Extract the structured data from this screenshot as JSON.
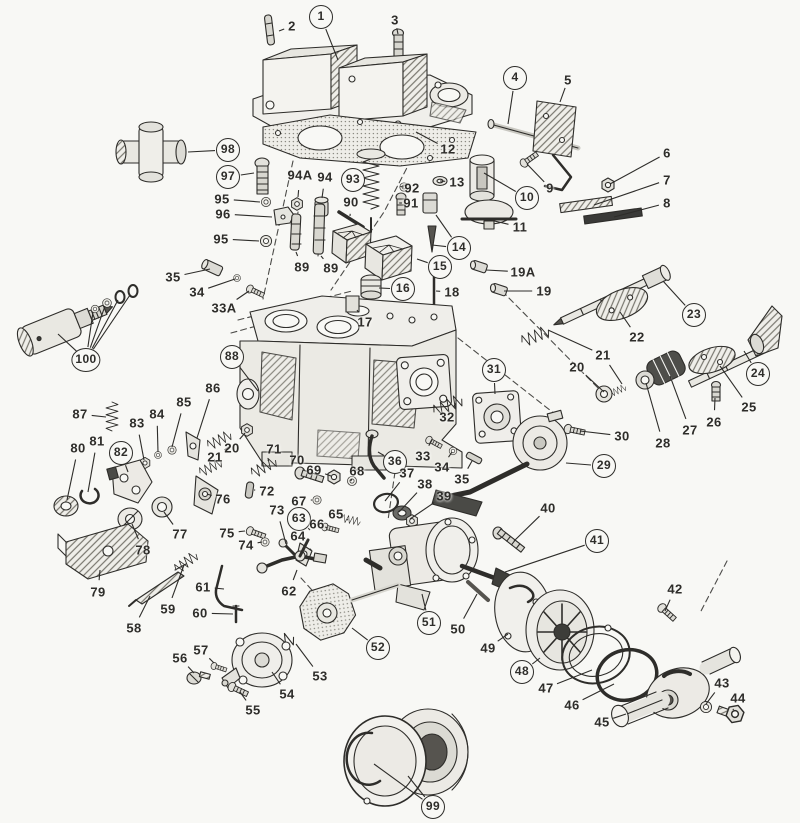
{
  "figure": {
    "kind": "exploded-parts-diagram",
    "canvas": {
      "w": 800,
      "h": 823
    }
  },
  "colors": {
    "paper": "#f8f8f5",
    "ink": "#2e2d2a"
  },
  "labels": [
    {
      "t": "1",
      "x": 321,
      "y": 17,
      "c": 1,
      "l": [
        [
          338,
          60
        ]
      ]
    },
    {
      "t": "2",
      "x": 292,
      "y": 26,
      "c": 0,
      "l": [
        [
          279,
          31
        ]
      ]
    },
    {
      "t": "3",
      "x": 395,
      "y": 20,
      "c": 0,
      "l": [
        [
          398,
          34
        ]
      ]
    },
    {
      "t": "4",
      "x": 515,
      "y": 78,
      "c": 1,
      "l": [
        [
          508,
          124
        ]
      ]
    },
    {
      "t": "5",
      "x": 568,
      "y": 80,
      "c": 0,
      "l": [
        [
          560,
          102
        ]
      ]
    },
    {
      "t": "6",
      "x": 667,
      "y": 153,
      "c": 0,
      "l": [
        [
          610,
          184
        ]
      ]
    },
    {
      "t": "7",
      "x": 667,
      "y": 180,
      "c": 0,
      "l": [
        [
          594,
          205
        ]
      ]
    },
    {
      "t": "8",
      "x": 667,
      "y": 203,
      "c": 0,
      "l": [
        [
          614,
          217
        ]
      ]
    },
    {
      "t": "9",
      "x": 550,
      "y": 188,
      "c": 0,
      "l": [
        [
          527,
          164
        ]
      ]
    },
    {
      "t": "10",
      "x": 527,
      "y": 198,
      "c": 1,
      "l": [
        [
          484,
          173
        ]
      ]
    },
    {
      "t": "11",
      "x": 520,
      "y": 227,
      "c": 0,
      "l": [
        [
          486,
          219
        ]
      ]
    },
    {
      "t": "12",
      "x": 448,
      "y": 149,
      "c": 0,
      "l": [
        [
          416,
          132
        ]
      ]
    },
    {
      "t": "13",
      "x": 457,
      "y": 182,
      "c": 0,
      "l": [
        [
          440,
          181
        ]
      ]
    },
    {
      "t": "14",
      "x": 459,
      "y": 248,
      "c": 1,
      "l": [
        [
          436,
          215
        ],
        [
          432,
          245
        ]
      ]
    },
    {
      "t": "15",
      "x": 440,
      "y": 267,
      "c": 1,
      "l": [
        [
          417,
          259
        ]
      ]
    },
    {
      "t": "16",
      "x": 403,
      "y": 289,
      "c": 1,
      "l": [
        [
          379,
          288
        ]
      ]
    },
    {
      "t": "17",
      "x": 365,
      "y": 322,
      "c": 0,
      "l": [
        [
          357,
          310
        ]
      ]
    },
    {
      "t": "18",
      "x": 452,
      "y": 292,
      "c": 0,
      "l": [
        [
          436,
          291
        ]
      ]
    },
    {
      "t": "19",
      "x": 544,
      "y": 291,
      "c": 0,
      "l": [
        [
          504,
          291
        ]
      ]
    },
    {
      "t": "19A",
      "x": 523,
      "y": 272,
      "c": 0,
      "l": [
        [
          486,
          270
        ]
      ]
    },
    {
      "t": "20",
      "x": 232,
      "y": 448,
      "c": 0,
      "l": [
        [
          245,
          433
        ]
      ]
    },
    {
      "t": "21",
      "x": 215,
      "y": 457,
      "c": 0,
      "l": [
        [
          230,
          446
        ]
      ]
    },
    {
      "t": "20",
      "x": 577,
      "y": 367,
      "c": 0,
      "l": [
        [
          604,
          392
        ]
      ]
    },
    {
      "t": "21",
      "x": 603,
      "y": 355,
      "c": 0,
      "l": [
        [
          548,
          330
        ],
        [
          622,
          384
        ]
      ]
    },
    {
      "t": "22",
      "x": 637,
      "y": 337,
      "c": 0,
      "l": [
        [
          620,
          312
        ]
      ]
    },
    {
      "t": "23",
      "x": 694,
      "y": 315,
      "c": 1,
      "l": [
        [
          663,
          281
        ]
      ]
    },
    {
      "t": "24",
      "x": 758,
      "y": 374,
      "c": 1,
      "l": [
        [
          744,
          351
        ]
      ]
    },
    {
      "t": "25",
      "x": 749,
      "y": 407,
      "c": 0,
      "l": [
        [
          720,
          366
        ]
      ]
    },
    {
      "t": "26",
      "x": 714,
      "y": 422,
      "c": 0,
      "l": [
        [
          715,
          398
        ]
      ]
    },
    {
      "t": "27",
      "x": 690,
      "y": 430,
      "c": 0,
      "l": [
        [
          670,
          376
        ]
      ]
    },
    {
      "t": "28",
      "x": 663,
      "y": 443,
      "c": 0,
      "l": [
        [
          646,
          383
        ]
      ]
    },
    {
      "t": "29",
      "x": 604,
      "y": 466,
      "c": 1,
      "l": [
        [
          566,
          463
        ]
      ]
    },
    {
      "t": "30",
      "x": 622,
      "y": 436,
      "c": 0,
      "l": [
        [
          580,
          431
        ]
      ]
    },
    {
      "t": "31",
      "x": 494,
      "y": 370,
      "c": 1,
      "l": [
        [
          495,
          394
        ]
      ]
    },
    {
      "t": "32",
      "x": 447,
      "y": 417,
      "c": 0,
      "l": [
        [
          456,
          403
        ]
      ]
    },
    {
      "t": "33",
      "x": 423,
      "y": 456,
      "c": 0,
      "l": [
        [
          432,
          440
        ]
      ]
    },
    {
      "t": "34",
      "x": 442,
      "y": 467,
      "c": 0,
      "l": [
        [
          452,
          452
        ]
      ]
    },
    {
      "t": "35",
      "x": 462,
      "y": 479,
      "c": 0,
      "l": [
        [
          472,
          461
        ]
      ]
    },
    {
      "t": "33A",
      "x": 224,
      "y": 308,
      "c": 0,
      "l": [
        [
          249,
          291
        ]
      ]
    },
    {
      "t": "34",
      "x": 197,
      "y": 292,
      "c": 0,
      "l": [
        [
          235,
          279
        ]
      ]
    },
    {
      "t": "35",
      "x": 173,
      "y": 277,
      "c": 0,
      "l": [
        [
          210,
          269
        ]
      ]
    },
    {
      "t": "36",
      "x": 395,
      "y": 462,
      "c": 1,
      "l": [
        [
          378,
          452
        ]
      ]
    },
    {
      "t": "37",
      "x": 407,
      "y": 473,
      "c": 0,
      "l": [
        [
          385,
          501
        ]
      ]
    },
    {
      "t": "38",
      "x": 425,
      "y": 484,
      "c": 0,
      "l": [
        [
          399,
          512
        ]
      ]
    },
    {
      "t": "39",
      "x": 444,
      "y": 496,
      "c": 0,
      "l": [
        [
          410,
          519
        ]
      ]
    },
    {
      "t": "40",
      "x": 548,
      "y": 508,
      "c": 0,
      "l": [
        [
          514,
          541
        ]
      ]
    },
    {
      "t": "41",
      "x": 597,
      "y": 541,
      "c": 1,
      "l": [
        [
          505,
          572
        ]
      ]
    },
    {
      "t": "42",
      "x": 675,
      "y": 589,
      "c": 0,
      "l": [
        [
          665,
          611
        ]
      ]
    },
    {
      "t": "43",
      "x": 722,
      "y": 683,
      "c": 0,
      "l": [
        [
          706,
          704
        ]
      ]
    },
    {
      "t": "44",
      "x": 738,
      "y": 698,
      "c": 0,
      "l": [
        [
          733,
          710
        ]
      ]
    },
    {
      "t": "45",
      "x": 602,
      "y": 722,
      "c": 0,
      "l": [
        [
          626,
          714
        ]
      ]
    },
    {
      "t": "46",
      "x": 572,
      "y": 705,
      "c": 0,
      "l": [
        [
          614,
          684
        ]
      ]
    },
    {
      "t": "47",
      "x": 546,
      "y": 688,
      "c": 0,
      "l": [
        [
          592,
          670
        ]
      ]
    },
    {
      "t": "48",
      "x": 522,
      "y": 672,
      "c": 1,
      "l": [
        [
          540,
          658
        ]
      ]
    },
    {
      "t": "49",
      "x": 488,
      "y": 648,
      "c": 0,
      "l": [
        [
          508,
          634
        ]
      ]
    },
    {
      "t": "50",
      "x": 458,
      "y": 629,
      "c": 0,
      "l": [
        [
          477,
          594
        ]
      ]
    },
    {
      "t": "51",
      "x": 429,
      "y": 623,
      "c": 1,
      "l": [
        [
          422,
          594
        ]
      ]
    },
    {
      "t": "52",
      "x": 378,
      "y": 648,
      "c": 1,
      "l": [
        [
          352,
          628
        ]
      ]
    },
    {
      "t": "53",
      "x": 320,
      "y": 676,
      "c": 0,
      "l": [
        [
          296,
          644
        ]
      ]
    },
    {
      "t": "54",
      "x": 287,
      "y": 694,
      "c": 0,
      "l": [
        [
          272,
          672
        ]
      ]
    },
    {
      "t": "55",
      "x": 253,
      "y": 710,
      "c": 0,
      "l": [
        [
          240,
          692
        ]
      ]
    },
    {
      "t": "56",
      "x": 180,
      "y": 658,
      "c": 0,
      "l": [
        [
          194,
          673
        ]
      ]
    },
    {
      "t": "57",
      "x": 201,
      "y": 650,
      "c": 0,
      "l": [
        [
          214,
          663
        ]
      ]
    },
    {
      "t": "58",
      "x": 134,
      "y": 628,
      "c": 0,
      "l": [
        [
          150,
          596
        ]
      ]
    },
    {
      "t": "59",
      "x": 168,
      "y": 609,
      "c": 0,
      "l": [
        [
          184,
          565
        ]
      ]
    },
    {
      "t": "60",
      "x": 200,
      "y": 613,
      "c": 0,
      "l": [
        [
          233,
          614
        ]
      ]
    },
    {
      "t": "61",
      "x": 203,
      "y": 587,
      "c": 0,
      "l": [
        [
          224,
          589
        ]
      ]
    },
    {
      "t": "62",
      "x": 289,
      "y": 591,
      "c": 0,
      "l": [
        [
          297,
          570
        ]
      ]
    },
    {
      "t": "63",
      "x": 299,
      "y": 519,
      "c": 1,
      "l": [
        [
          310,
          530
        ]
      ]
    },
    {
      "t": "64",
      "x": 298,
      "y": 536,
      "c": 0,
      "l": [
        [
          304,
          547
        ]
      ]
    },
    {
      "t": "65",
      "x": 336,
      "y": 514,
      "c": 0,
      "l": [
        [
          348,
          520
        ]
      ]
    },
    {
      "t": "66",
      "x": 317,
      "y": 524,
      "c": 0,
      "l": [
        [
          325,
          527
        ]
      ]
    },
    {
      "t": "67",
      "x": 299,
      "y": 501,
      "c": 0,
      "l": [
        [
          312,
          500
        ]
      ]
    },
    {
      "t": "68",
      "x": 357,
      "y": 471,
      "c": 0,
      "l": [
        [
          352,
          479
        ]
      ]
    },
    {
      "t": "69",
      "x": 314,
      "y": 470,
      "c": 0,
      "l": [
        [
          331,
          476
        ]
      ]
    },
    {
      "t": "70",
      "x": 297,
      "y": 460,
      "c": 0,
      "l": [
        [
          303,
          470
        ]
      ]
    },
    {
      "t": "71",
      "x": 274,
      "y": 449,
      "c": 0,
      "l": [
        [
          268,
          461
        ]
      ]
    },
    {
      "t": "72",
      "x": 267,
      "y": 491,
      "c": 0,
      "l": [
        [
          254,
          490
        ]
      ]
    },
    {
      "t": "73",
      "x": 277,
      "y": 510,
      "c": 0,
      "l": [
        [
          286,
          544
        ]
      ]
    },
    {
      "t": "74",
      "x": 246,
      "y": 545,
      "c": 0,
      "l": [
        [
          262,
          542
        ]
      ]
    },
    {
      "t": "75",
      "x": 227,
      "y": 533,
      "c": 0,
      "l": [
        [
          245,
          531
        ]
      ]
    },
    {
      "t": "76",
      "x": 223,
      "y": 499,
      "c": 0,
      "l": [
        [
          207,
          494
        ]
      ]
    },
    {
      "t": "77",
      "x": 180,
      "y": 534,
      "c": 0,
      "l": [
        [
          164,
          512
        ]
      ]
    },
    {
      "t": "78",
      "x": 143,
      "y": 550,
      "c": 0,
      "l": [
        [
          132,
          524
        ]
      ]
    },
    {
      "t": "79",
      "x": 98,
      "y": 592,
      "c": 0,
      "l": [
        [
          100,
          570
        ]
      ]
    },
    {
      "t": "80",
      "x": 78,
      "y": 448,
      "c": 0,
      "l": [
        [
          67,
          500
        ]
      ]
    },
    {
      "t": "81",
      "x": 97,
      "y": 441,
      "c": 0,
      "l": [
        [
          88,
          492
        ]
      ]
    },
    {
      "t": "82",
      "x": 121,
      "y": 453,
      "c": 1,
      "l": [
        [
          128,
          472
        ]
      ]
    },
    {
      "t": "83",
      "x": 137,
      "y": 423,
      "c": 0,
      "l": [
        [
          144,
          460
        ]
      ]
    },
    {
      "t": "84",
      "x": 157,
      "y": 414,
      "c": 0,
      "l": [
        [
          158,
          452
        ]
      ]
    },
    {
      "t": "85",
      "x": 184,
      "y": 402,
      "c": 0,
      "l": [
        [
          172,
          447
        ]
      ]
    },
    {
      "t": "86",
      "x": 213,
      "y": 388,
      "c": 0,
      "l": [
        [
          197,
          438
        ]
      ]
    },
    {
      "t": "87",
      "x": 80,
      "y": 414,
      "c": 0,
      "l": [
        [
          106,
          417
        ]
      ]
    },
    {
      "t": "88",
      "x": 232,
      "y": 357,
      "c": 1,
      "l": [
        [
          258,
          391
        ]
      ]
    },
    {
      "t": "89",
      "x": 302,
      "y": 267,
      "c": 0,
      "l": [
        [
          296,
          252
        ]
      ]
    },
    {
      "t": "89",
      "x": 331,
      "y": 268,
      "c": 0,
      "l": [
        [
          321,
          256
        ]
      ]
    },
    {
      "t": "90",
      "x": 351,
      "y": 202,
      "c": 0,
      "l": [
        [
          350,
          216
        ]
      ]
    },
    {
      "t": "91",
      "x": 411,
      "y": 203,
      "c": 0,
      "l": [
        [
          402,
          203
        ]
      ]
    },
    {
      "t": "92",
      "x": 412,
      "y": 188,
      "c": 0,
      "l": [
        [
          404,
          187
        ]
      ]
    },
    {
      "t": "93",
      "x": 353,
      "y": 180,
      "c": 1,
      "l": [
        [
          366,
          181
        ]
      ]
    },
    {
      "t": "94",
      "x": 325,
      "y": 177,
      "c": 0,
      "l": [
        [
          322,
          198
        ]
      ]
    },
    {
      "t": "94A",
      "x": 300,
      "y": 175,
      "c": 0,
      "l": [
        [
          298,
          197
        ]
      ]
    },
    {
      "t": "95",
      "x": 222,
      "y": 199,
      "c": 0,
      "l": [
        [
          260,
          202
        ]
      ]
    },
    {
      "t": "95",
      "x": 221,
      "y": 239,
      "c": 0,
      "l": [
        [
          259,
          241
        ]
      ]
    },
    {
      "t": "96",
      "x": 223,
      "y": 214,
      "c": 0,
      "l": [
        [
          272,
          217
        ]
      ]
    },
    {
      "t": "97",
      "x": 228,
      "y": 177,
      "c": 1,
      "l": [
        [
          254,
          173
        ]
      ]
    },
    {
      "t": "98",
      "x": 228,
      "y": 150,
      "c": 1,
      "l": [
        [
          188,
          152
        ]
      ]
    },
    {
      "t": "99",
      "x": 433,
      "y": 807,
      "c": 1,
      "l": [
        [
          408,
          776
        ],
        [
          374,
          764
        ]
      ]
    },
    {
      "t": "100",
      "x": 86,
      "y": 360,
      "c": 1,
      "l": [
        [
          58,
          334
        ],
        [
          93,
          312
        ],
        [
          105,
          306
        ],
        [
          118,
          300
        ],
        [
          130,
          295
        ]
      ]
    }
  ]
}
